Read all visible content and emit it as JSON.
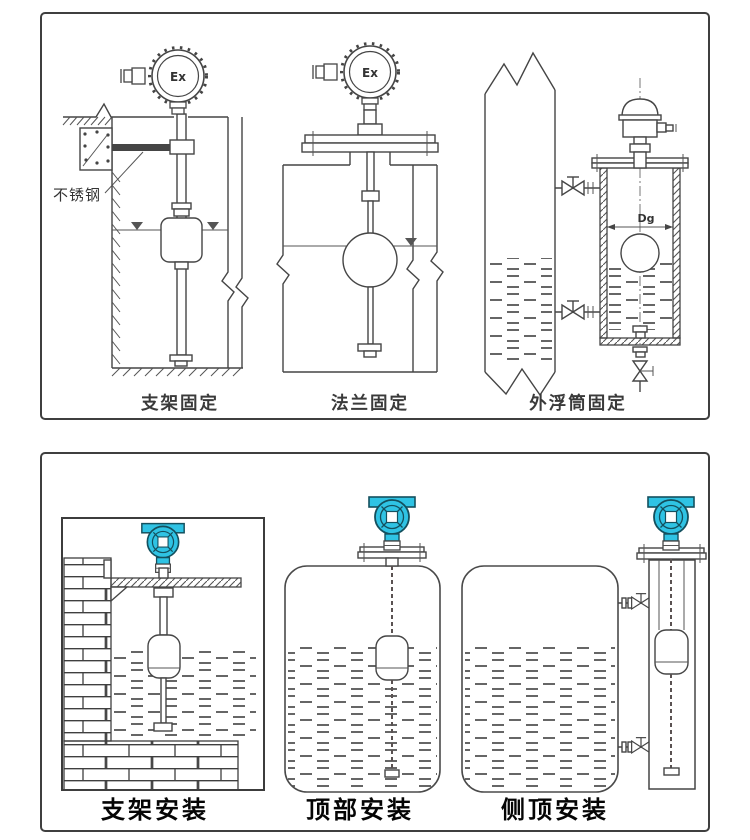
{
  "colors": {
    "background": "#ffffff",
    "line": "#454545",
    "panel_border": "#3f3f3f",
    "transmitter_cyan": "#2fc3e4",
    "transmitter_cyan_dark": "#14505e",
    "caption_top": "#3a3a3a",
    "caption_bottom": "#050505"
  },
  "top_panel": {
    "diagrams": [
      {
        "id": "bracket-fixing",
        "caption": "支架固定",
        "labels": {
          "material": "不锈钢",
          "head": "Ex"
        }
      },
      {
        "id": "flange-fixing",
        "caption": "法兰固定",
        "labels": {
          "head": "Ex"
        }
      },
      {
        "id": "external-chamber-fixing",
        "caption": "外浮筒固定",
        "labels": {
          "diameter": "Dg"
        }
      }
    ]
  },
  "bottom_panel": {
    "diagrams": [
      {
        "id": "bracket-installation",
        "caption": "支架安装"
      },
      {
        "id": "top-installation",
        "caption": "顶部安装"
      },
      {
        "id": "side-top-installation",
        "caption": "侧顶安装"
      }
    ]
  }
}
